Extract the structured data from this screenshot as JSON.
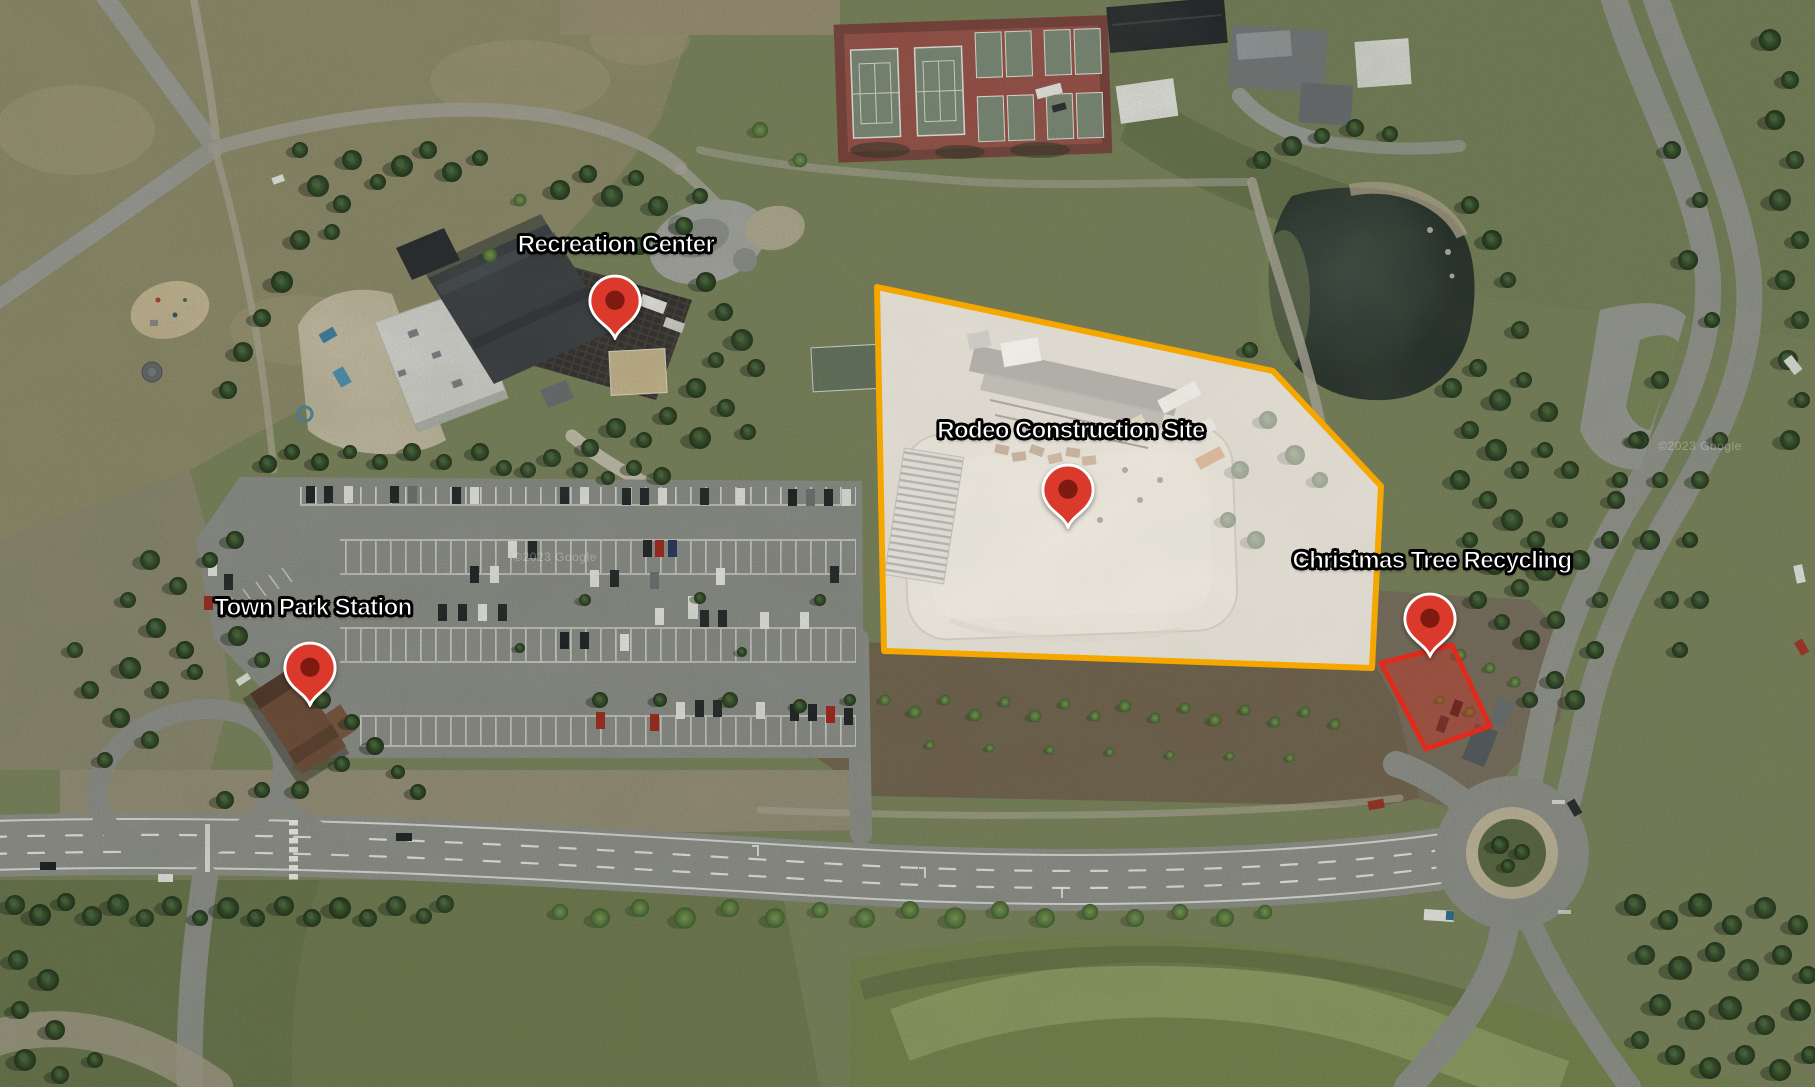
{
  "map": {
    "view": "Satellite",
    "markers": [
      {
        "id": "recreation-center",
        "label": "Recreation Center",
        "pin_x": 615,
        "pin_y": 340,
        "label_x": 616,
        "label_y": 245
      },
      {
        "id": "rodeo-construction-site",
        "label": "Rodeo Construction Site",
        "pin_x": 1068,
        "pin_y": 529,
        "label_x": 1071,
        "label_y": 431
      },
      {
        "id": "christmas-tree-recycling",
        "label": "Christmas Tree Recycling",
        "pin_x": 1430,
        "pin_y": 658,
        "label_x": 1432,
        "label_y": 561
      },
      {
        "id": "town-park-station",
        "label": "Town Park Station",
        "pin_x": 310,
        "pin_y": 707,
        "label_x": 313,
        "label_y": 608
      }
    ],
    "pin_style": {
      "fill": "#DB392C",
      "dot": "#7E1A10",
      "outline": "#FFFFFF"
    },
    "zones": [
      {
        "id": "rodeo-construction-site-boundary",
        "stroke": "#F5A700",
        "stroke_width": 6,
        "fill": "rgba(255,252,244,0.55)",
        "points": "877,287 1273,371 1381,486 1372,668 884,651"
      },
      {
        "id": "christmas-tree-recycling-area",
        "stroke": "#E12A1C",
        "stroke_width": 5,
        "fill": "rgba(219,45,30,0.38)",
        "points": "1381,663 1452,645 1490,726 1426,749"
      }
    ],
    "watermark": "©2023 Google"
  }
}
